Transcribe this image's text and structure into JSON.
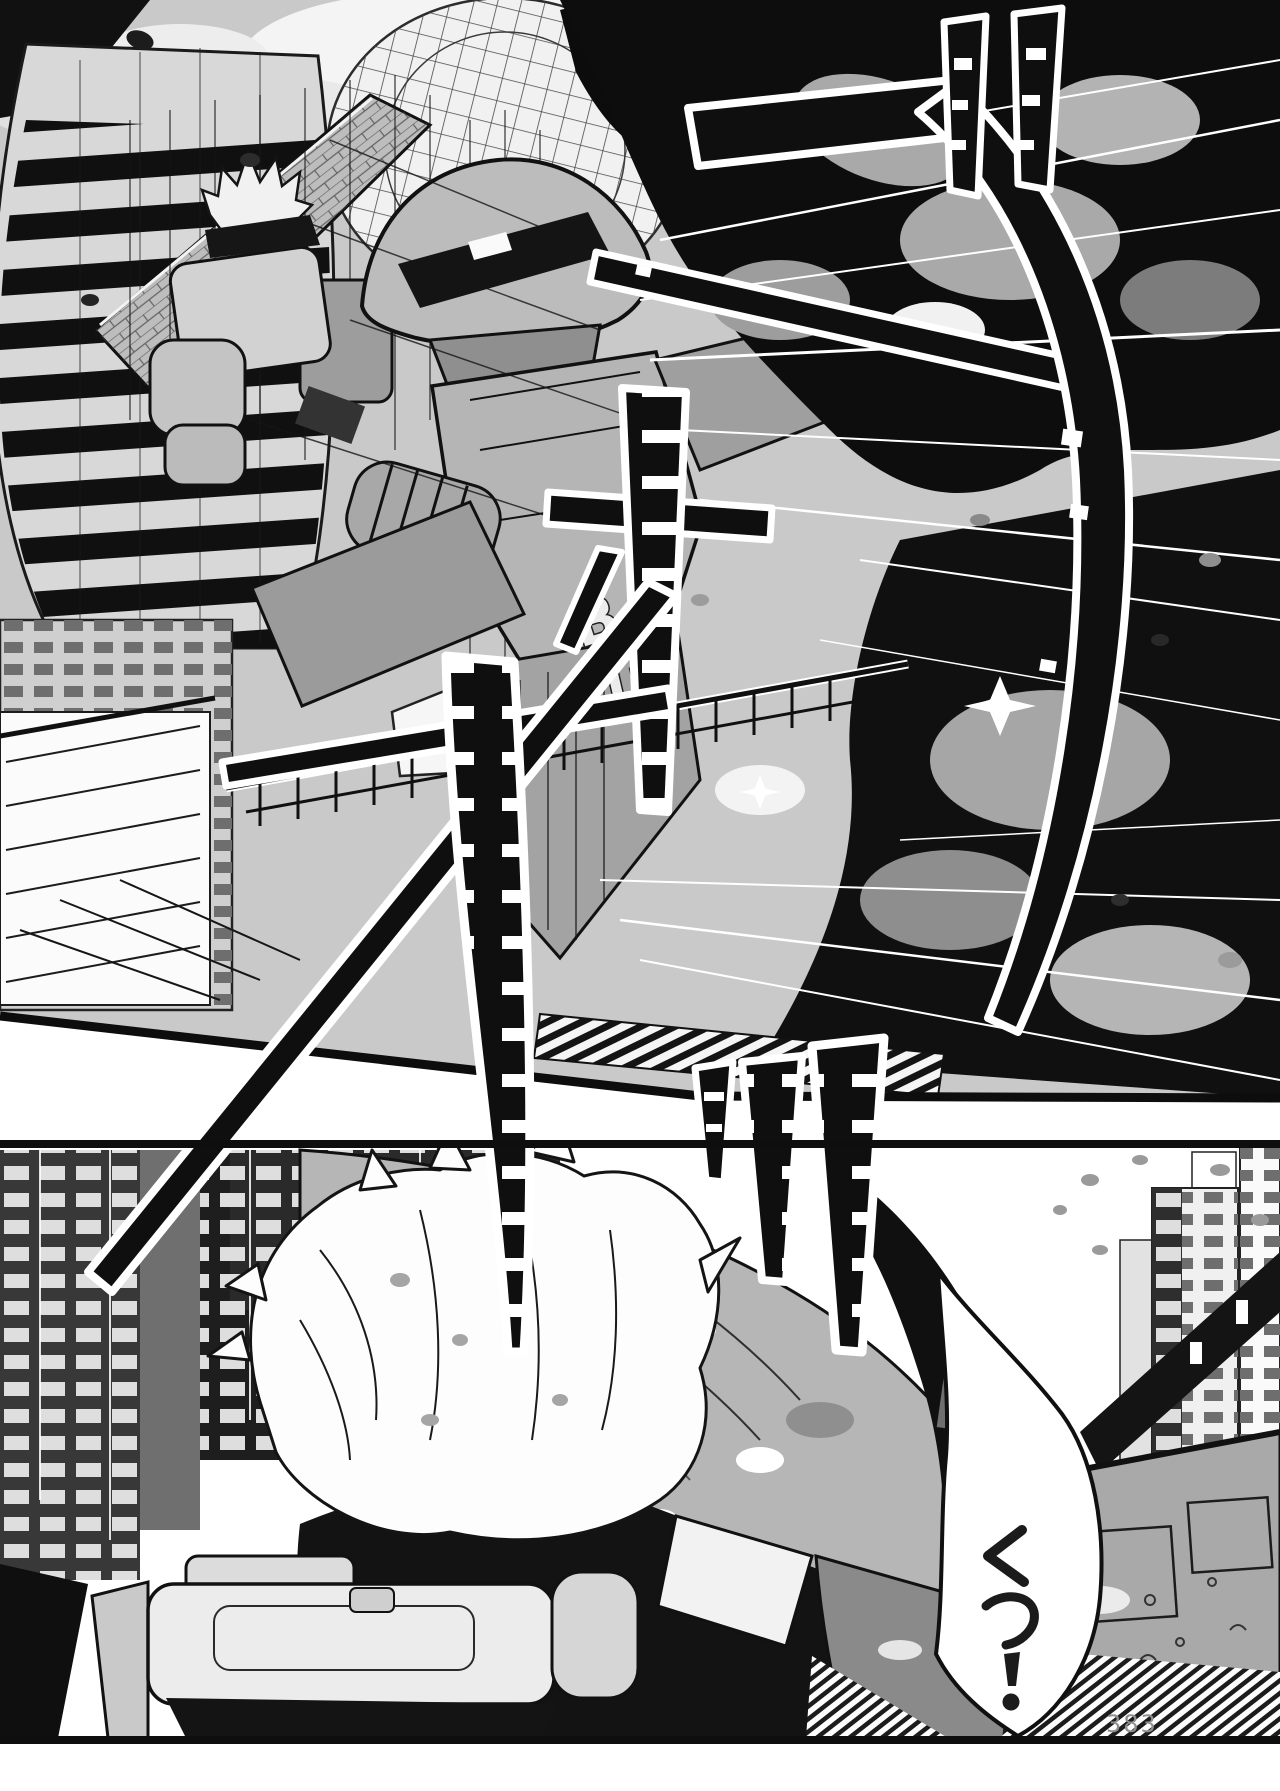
{
  "page": {
    "number": "383"
  },
  "panel1": {
    "sound_effects": [
      {
        "text": "ブ",
        "position": "top-right",
        "style": "giant brush katakana, black with white outline"
      },
      {
        "text": "ッ",
        "position": "top-right-corner",
        "style": "two tapered bars with white notches"
      },
      {
        "text": "ォ",
        "position": "center",
        "style": "ladder-striped vertical bar with cross stroke"
      },
      {
        "text": "ォ",
        "position": "center-left crossing panel gutter",
        "style": "long crossed bars and ladder bar"
      }
    ],
    "mecha_lettering": {
      "b": "B",
      "u": "U"
    }
  },
  "panel2": {
    "sound_effects": [
      {
        "text": "ッ",
        "position": "center",
        "style": "small tapered ladder bar"
      },
      {
        "text": "ッ",
        "position": "center-right",
        "style": "tall tapered ladder bar"
      }
    ],
    "speech_bubble": {
      "text": "くっ!",
      "orientation": "vertical"
    }
  },
  "colors": {
    "ink": "#111111",
    "paper": "#ffffff",
    "sky_tone": "#c9c9c9",
    "smoke_tone": "#a9a9a9",
    "page_number": "#8f8f8f"
  }
}
